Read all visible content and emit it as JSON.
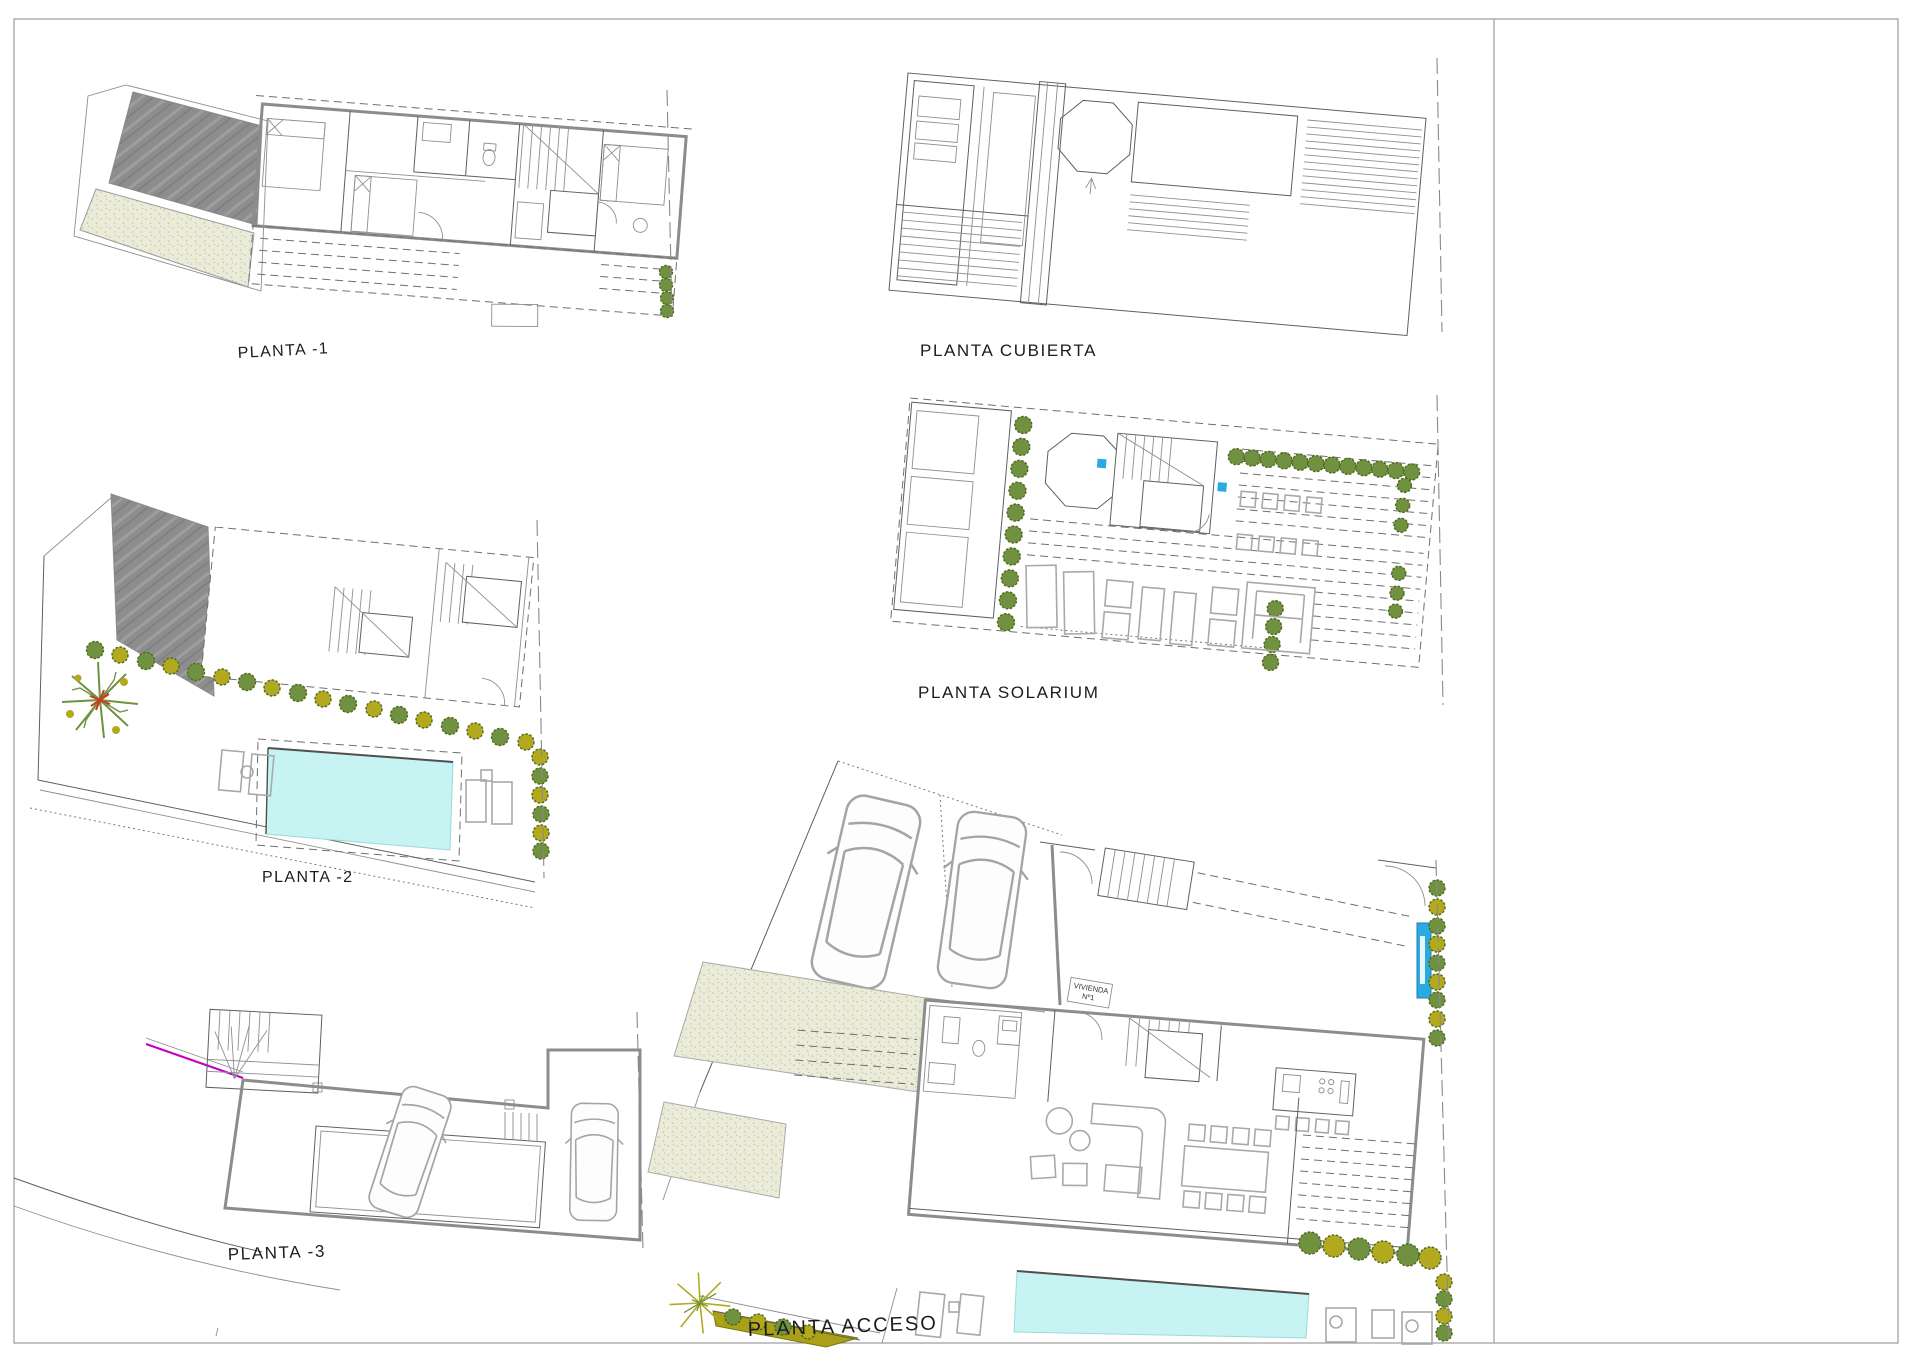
{
  "sheet": {
    "background": "#ffffff",
    "border_color": "#9b9b9b",
    "colors": {
      "roof_gray": "#8d8d8d",
      "terrace_beige": "#eaebd8",
      "terrace_dot": "#c2c39b",
      "pool_fill": "#c7f3f2",
      "pool_edge": "#4f4f4f",
      "accent_blue": "#29abe2",
      "tree_green": "#6f9140",
      "tree_olive": "#b3a91e",
      "tree_red": "#cc3b1e",
      "magenta": "#c400c4",
      "veg_strip": "#a9a017"
    },
    "plans": [
      {
        "id": "planta_m1",
        "label": "PLANTA  -1"
      },
      {
        "id": "planta_cubierta",
        "label": "PLANTA CUBIERTA"
      },
      {
        "id": "planta_solarium",
        "label": "PLANTA SOLARIUM"
      },
      {
        "id": "planta_m2",
        "label": "PLANTA  -2"
      },
      {
        "id": "planta_m3",
        "label": "PLANTA  -3"
      },
      {
        "id": "planta_acceso",
        "label": "PLANTA  ACCESO"
      }
    ],
    "tags": {
      "vivienda_line1": "VIVIENDA",
      "vivienda_line2": "Nº1"
    }
  }
}
